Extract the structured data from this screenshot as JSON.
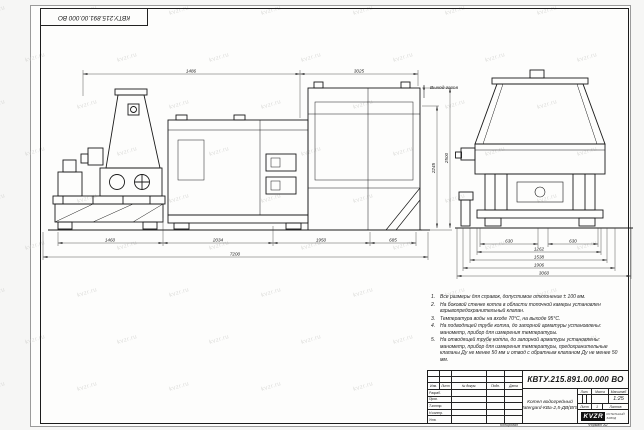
{
  "sheet": {
    "stamp_top_left": "КВТУ.215.891.00.000 ВО",
    "copied_label": "Копировал",
    "format_label": "Формат А2"
  },
  "watermark": {
    "text": "kvzr.ru"
  },
  "front_view": {
    "gas_outlet_label": "Выход газов",
    "dim_top_left": "1486",
    "dim_top_right": "3025",
    "dim_bottom_1": "1460",
    "dim_bottom_2": "2034",
    "dim_bottom_3": "1950",
    "dim_bottom_4": "685",
    "dim_total": "7200",
    "dim_height_inner": "2245",
    "dim_height_outer": "2500"
  },
  "side_view": {
    "dim_1": "630",
    "dim_2": "630",
    "dim_3": "1262",
    "dim_4": "1538",
    "dim_5": "1906",
    "dim_6": "3060"
  },
  "notes": {
    "items": [
      {
        "num": "1.",
        "text": "Все размеры для справок, допустимое отклонение ± 100 мм."
      },
      {
        "num": "2.",
        "text": "На боковой стенке котла в области топочной камеры установлен взрывопредохранительный клапан."
      },
      {
        "num": "3.",
        "text": "Температура воды на входе 70°С, на выходе 95°С."
      },
      {
        "num": "4.",
        "text": "На подводящей трубе котла, до запорной арматуры установлены: манометр, прибор для измерения температуры."
      },
      {
        "num": "5.",
        "text": "На отводящей трубе котла, до запорной арматуры установлены: манометр, прибор для измерения температуры, предохранительные клапаны Ду не менее 50 мм и отвод с обратным клапаном Ду не менее 50 мм."
      }
    ]
  },
  "title_block": {
    "doc_number": "КВТУ.215.891.00.000 ВО",
    "product_line1": "Котел водогрейный",
    "product_line2": "Watergard-КВа-2,5-ДВ(ВПК)",
    "col_izm": "Изм.",
    "col_list": "Лист",
    "col_doc": "№ докум.",
    "col_podp": "Подп.",
    "col_data": "Дата",
    "row_razrab": "Разраб.",
    "row_prov": "Пров.",
    "row_tkontr": "Т.контр.",
    "row_nkontr": "Н.контр.",
    "row_utv": "Утв.",
    "lit_label": "Лит.",
    "mass_label": "Масса",
    "scale_label": "Масштаб",
    "scale_value": "1:25",
    "sheet_label": "Лист",
    "sheet_value": "1",
    "sheets_label": "Листов",
    "logo_text": "KVZR",
    "company_line1": "КОТЕЛЬНЫЙ",
    "company_line2": "ЗАВОД"
  }
}
